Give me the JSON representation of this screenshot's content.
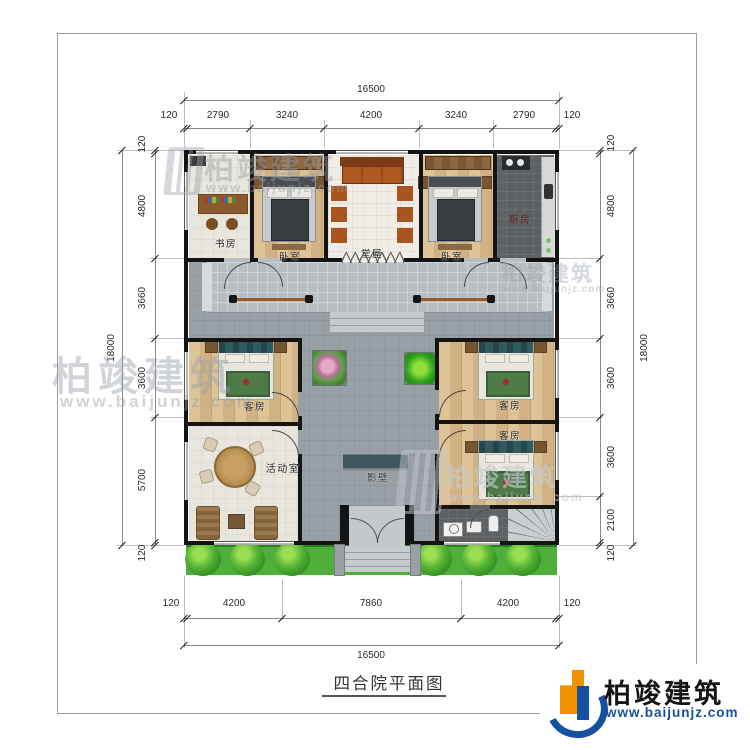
{
  "frame": {
    "title": "四合院平面图"
  },
  "logo": {
    "brand": "柏竣建筑",
    "url": "www.baijunjz.com"
  },
  "watermark": {
    "brand": "柏竣建筑",
    "url": "www.baijunjz.com"
  },
  "plan": {
    "rooms": {
      "study": "书房",
      "bedroom_left": "卧室",
      "hall": "堂屋",
      "bedroom_right": "卧室",
      "kitchen": "厨房",
      "guest_left": "客房",
      "activity": "活动室",
      "guest_right_top": "客房",
      "guest_right_bottom": "客房",
      "screen_wall": "影壁"
    }
  },
  "dims": {
    "top": {
      "total": "16500",
      "segments": [
        "120",
        "2790",
        "3240",
        "4200",
        "3240",
        "2790",
        "120"
      ]
    },
    "bottom": {
      "total": "16500",
      "segments": [
        "120",
        "4200",
        "7860",
        "4200",
        "120"
      ]
    },
    "left": {
      "total": "18000",
      "segments": [
        "120",
        "4800",
        "3660",
        "3600",
        "5700",
        "120"
      ]
    },
    "right": {
      "total": "18000",
      "segments": [
        "120",
        "4800",
        "3660",
        "3600",
        "3600",
        "2100",
        "120"
      ]
    }
  },
  "colors": {
    "wall": "#141414",
    "courtyard": "#99a0a5",
    "wood_floor": "#d8bb8e",
    "kitchen_floor": "#5d6164",
    "green_strip": "#4fae3c",
    "screen_wall": "#3e565c",
    "logo_blue": "#1650a0",
    "logo_orange": "#f29200"
  }
}
